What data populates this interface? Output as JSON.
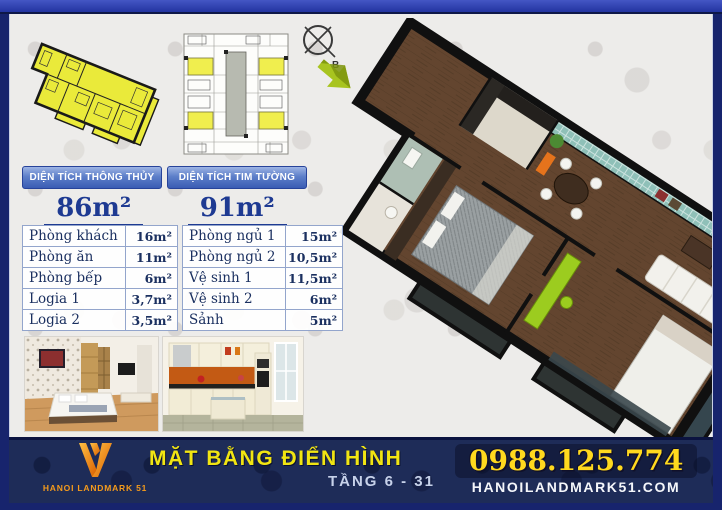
{
  "header_panels": {
    "net": {
      "label": "DIỆN TÍCH THÔNG THỦY",
      "value": "86m²"
    },
    "gross": {
      "label": "DIỆN TÍCH TIM TƯỜNG",
      "value": "91m²"
    }
  },
  "room_table": {
    "left": [
      {
        "name": "Phòng khách",
        "area": "16m²"
      },
      {
        "name": "Phòng ăn",
        "area": "11m²"
      },
      {
        "name": "Phòng bếp",
        "area": "6m²"
      },
      {
        "name": "Logia 1",
        "area": "3,7m²"
      },
      {
        "name": "Logia 2",
        "area": "3,5m²"
      }
    ],
    "right": [
      {
        "name": "Phòng ngủ 1",
        "area": "15m²"
      },
      {
        "name": "Phòng ngủ 2",
        "area": "10,5m²"
      },
      {
        "name": "Vệ sinh 1",
        "area": "11,5m²"
      },
      {
        "name": "Vệ sinh 2",
        "area": "6m²"
      },
      {
        "name": "Sảnh",
        "area": "5m²"
      }
    ]
  },
  "compass": {
    "label": "B"
  },
  "footer": {
    "logo_text": "HANOI LANDMARK 51",
    "title": "MẶT BẰNG ĐIỂN HÌNH",
    "subtitle": "TẦNG 6 - 31",
    "phone": "0988.125.774",
    "website": "HANOILANDMARK51.COM"
  },
  "colors": {
    "frame_navy": "#17246d",
    "top_border_blue": "#2c3cac",
    "panel_blue": "#3f63b6",
    "navy_text": "#1e3a92",
    "footer_navy": "#1e2c58",
    "title_yellow": "#f1e512",
    "phone_yellow": "#ffd91e",
    "logo_orange": "#f59b1c",
    "unit_highlight_yellow": "#eaea3a",
    "arrow_green": "#a8c41f",
    "teal_wall": "#8fc0b8",
    "wood_floor": "#63452f",
    "lime_furniture": "#9ccc1f"
  }
}
